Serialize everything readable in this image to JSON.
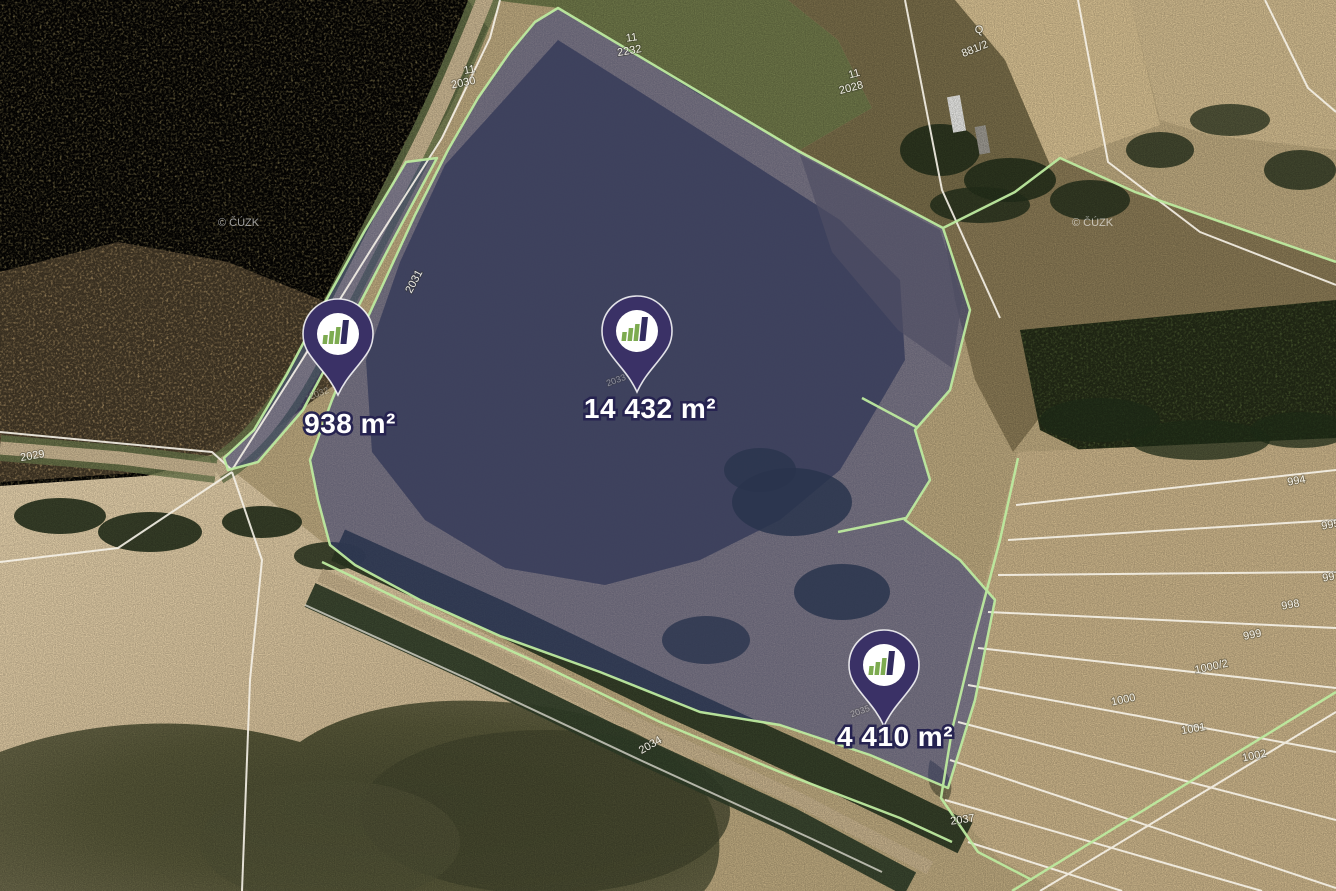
{
  "map": {
    "view": "satellite-cadastre",
    "attribution": {
      "text": "© ČÚZK",
      "positions": [
        {
          "x": 218,
          "y": 226
        },
        {
          "x": 1072,
          "y": 226
        }
      ]
    },
    "pins": [
      {
        "id": "pin-938",
        "area": "938 m²",
        "tip_x": 338,
        "tip_y": 395,
        "label_x": 350,
        "label_y": 433
      },
      {
        "id": "pin-14432",
        "area": "14 432 m²",
        "tip_x": 637,
        "tip_y": 392,
        "label_x": 650,
        "label_y": 418
      },
      {
        "id": "pin-4410",
        "area": "4 410 m²",
        "tip_x": 884,
        "tip_y": 726,
        "label_x": 895,
        "label_y": 746
      }
    ],
    "parcel_labels": [
      {
        "text": "11",
        "x": 470,
        "y": 73,
        "rot": -10
      },
      {
        "text": "2030",
        "x": 464,
        "y": 86,
        "rot": -12
      },
      {
        "text": "11",
        "x": 632,
        "y": 41,
        "rot": -8
      },
      {
        "text": "2232",
        "x": 630,
        "y": 54,
        "rot": -10
      },
      {
        "text": "11",
        "x": 855,
        "y": 77,
        "rot": -15
      },
      {
        "text": "2028",
        "x": 852,
        "y": 91,
        "rot": -15
      },
      {
        "text": "Q",
        "x": 979,
        "y": 33,
        "rot": 0
      },
      {
        "text": "881/2",
        "x": 976,
        "y": 52,
        "rot": -22
      },
      {
        "text": "2031",
        "x": 417,
        "y": 283,
        "rot": -62
      },
      {
        "text": "2029",
        "x": 33,
        "y": 459,
        "rot": -10
      },
      {
        "text": "2032",
        "x": 320,
        "y": 396,
        "rot": -20,
        "faint": true
      },
      {
        "text": "2033",
        "x": 617,
        "y": 383,
        "rot": -20,
        "faint": true
      },
      {
        "text": "2035",
        "x": 861,
        "y": 714,
        "rot": -20,
        "faint": true
      },
      {
        "text": "2034",
        "x": 652,
        "y": 748,
        "rot": -30
      },
      {
        "text": "2037",
        "x": 963,
        "y": 823,
        "rot": -8
      },
      {
        "text": "994",
        "x": 1297,
        "y": 484,
        "rot": -10
      },
      {
        "text": "995",
        "x": 1331,
        "y": 528,
        "rot": -10
      },
      {
        "text": "997",
        "x": 1332,
        "y": 580,
        "rot": -10
      },
      {
        "text": "998",
        "x": 1291,
        "y": 608,
        "rot": -10
      },
      {
        "text": "999",
        "x": 1253,
        "y": 638,
        "rot": -12
      },
      {
        "text": "1000/2",
        "x": 1212,
        "y": 670,
        "rot": -12
      },
      {
        "text": "1000",
        "x": 1124,
        "y": 703,
        "rot": -12
      },
      {
        "text": "1001",
        "x": 1194,
        "y": 732,
        "rot": -10
      },
      {
        "text": "1002",
        "x": 1255,
        "y": 759,
        "rot": -12
      }
    ],
    "colors": {
      "pin_body": "#3a3166",
      "pin_circle": "#ffffff",
      "logo_green": "#7dab50",
      "logo_dark": "#312b5e",
      "parcel_overlay": "#343d7c",
      "parcel_outline": "#bdea9f",
      "cadastral_line": "#f6f2e8",
      "label_text": "#ffffff",
      "label_outline": "#262350"
    }
  }
}
